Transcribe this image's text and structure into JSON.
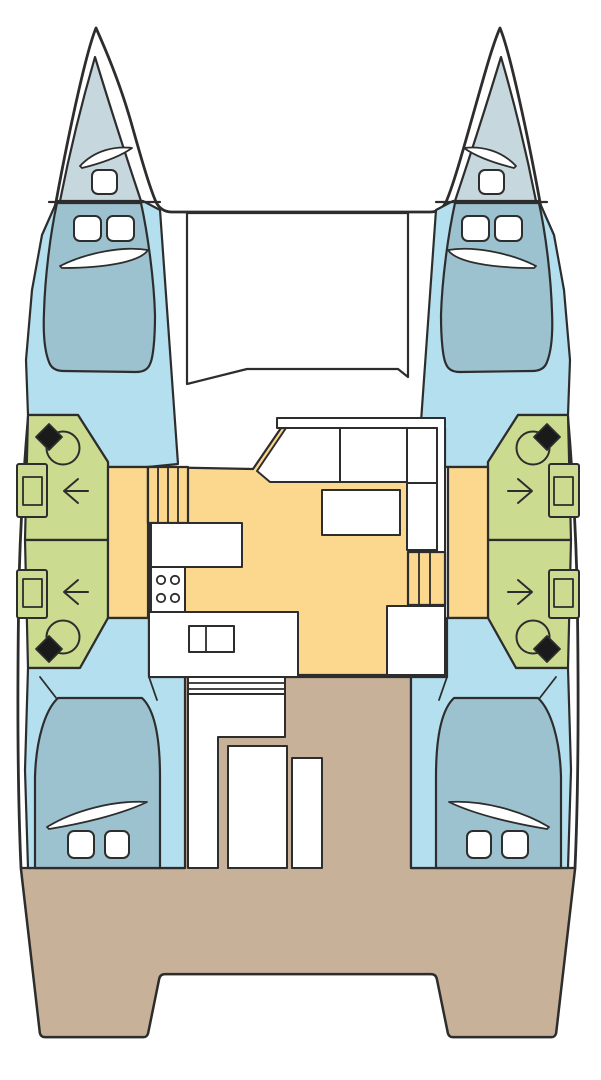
{
  "diagram": {
    "kind": "boat-floor-plan",
    "vessel_type": "catamaran",
    "view": "top-down deck plan, bows up, symmetric twin hulls",
    "hulls": [
      "port",
      "starboard"
    ],
    "areas": {
      "port_bow_locker": {
        "features": [
          "hull-window-swoosh",
          "deck-hatch"
        ]
      },
      "starboard_bow_locker": {
        "features": [
          "hull-window-swoosh",
          "deck-hatch"
        ]
      },
      "foredeck_trampoline": {
        "features": [
          "open-deck-panel"
        ]
      },
      "port_forward_cabin": {
        "features": [
          "double-berth",
          "deck-hatch",
          "deck-hatch",
          "hull-window-swoosh"
        ]
      },
      "starboard_forward_cabin": {
        "features": [
          "double-berth",
          "deck-hatch",
          "deck-hatch",
          "hull-window-swoosh"
        ]
      },
      "port_forward_bathroom": {
        "features": [
          "toilet",
          "sink",
          "door-arrow-left"
        ]
      },
      "port_aft_bathroom": {
        "features": [
          "toilet",
          "sink",
          "door-arrow-left"
        ]
      },
      "starboard_forward_bathroom": {
        "features": [
          "toilet",
          "sink",
          "door-arrow-right"
        ]
      },
      "starboard_aft_bathroom": {
        "features": [
          "toilet",
          "sink",
          "door-arrow-right"
        ]
      },
      "port_companionway_stairs": {
        "steps": 4
      },
      "starboard_companionway_stairs": {
        "steps": 3
      },
      "port_hull_corridor": {},
      "starboard_hull_corridor": {},
      "saloon": {
        "features": [
          "l-shaped-settee",
          "settee-backrest",
          "dinette-table"
        ]
      },
      "galley": {
        "features": [
          "upper-counter",
          "stove-4-burners",
          "lower-counter",
          "double-sink"
        ]
      },
      "starboard_aft_module": {
        "features": [
          "cabinet"
        ]
      },
      "companionway_door_cluster": {
        "features": [
          "lined-sideboard",
          "step-column",
          "door-panel",
          "window-panel"
        ]
      },
      "port_aft_cabin": {
        "features": [
          "double-berth",
          "hull-window-swoosh",
          "deck-hatch",
          "deck-hatch"
        ]
      },
      "starboard_aft_cabin": {
        "features": [
          "double-berth",
          "hull-window-swoosh",
          "deck-hatch",
          "deck-hatch"
        ]
      },
      "cockpit": {
        "features": [
          "transom-platform-notch"
        ]
      }
    }
  },
  "colors": {
    "background": "#ffffff",
    "outline": "#2d2d2d",
    "deck_white": "#ffffff",
    "bow_locker": "#c6d8dd",
    "berth": "#9cc2cf",
    "cabin_floor": "#b3dfee",
    "bathroom": "#cbdc90",
    "saloon": "#fcd88e",
    "cockpit": "#c8b199",
    "furniture": "#ffffff",
    "toilet_tank": "#1a1a1a"
  }
}
